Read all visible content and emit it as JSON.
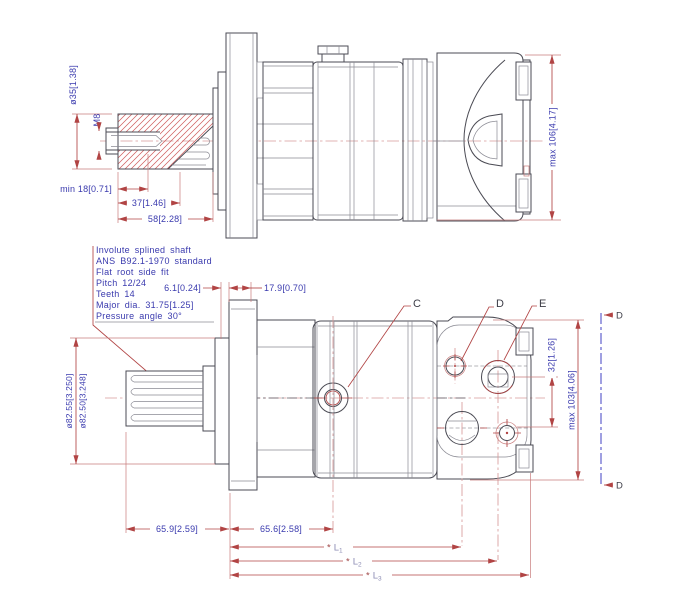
{
  "top_view": {
    "dim_shaft_dia": "ø35[1.38]",
    "thread_label": "M8",
    "dim_thread_depth": "min 18[0.71]",
    "dim_shaft_step": "37[1.46]",
    "dim_shaft_length": "58[2.28]",
    "dim_overall_height": "max 106[4.17]"
  },
  "spline_note": {
    "lines": [
      "Involute splined shaft",
      "ANS B92.1-1970 standard",
      "Flat root side fit",
      "Pitch 12/24",
      "Teeth 14",
      "Major dia. 31.75[1.25]",
      "Pressure angle 30°"
    ]
  },
  "bottom_view": {
    "dim_pilot_gap": "6.1[0.24]",
    "dim_flange_thickness": "17.9[0.70]",
    "dim_pilot_dia_max": "ø82.55[3.250]",
    "dim_pilot_dia_min": "ø82.50[3.248]",
    "dim_shaft_to_flange": "65.9[2.59]",
    "dim_flange_to_port": "65.6[2.58]",
    "dim_port_spacing": "32[1.26]",
    "dim_overall_height": "max 103[4.06]",
    "port_labels": {
      "c": "C",
      "d": "D",
      "e": "E"
    },
    "length_dims": [
      {
        "prefix": "*",
        "name": "L",
        "sub": "1"
      },
      {
        "prefix": "*",
        "name": "L",
        "sub": "2"
      },
      {
        "prefix": "*",
        "name": "L",
        "sub": "3"
      }
    ]
  },
  "section": {
    "label_top": "D",
    "label_bottom": "D"
  },
  "colors": {
    "dimension_red": "#b14444",
    "text_blue": "#3a3aae",
    "centerline_pink": "#d89a9a",
    "section_blue": "#5353c8",
    "outline_gray": "#4b4b54",
    "hatch_red": "#cd5c5c",
    "l_label_lavender": "#8d8db4"
  }
}
